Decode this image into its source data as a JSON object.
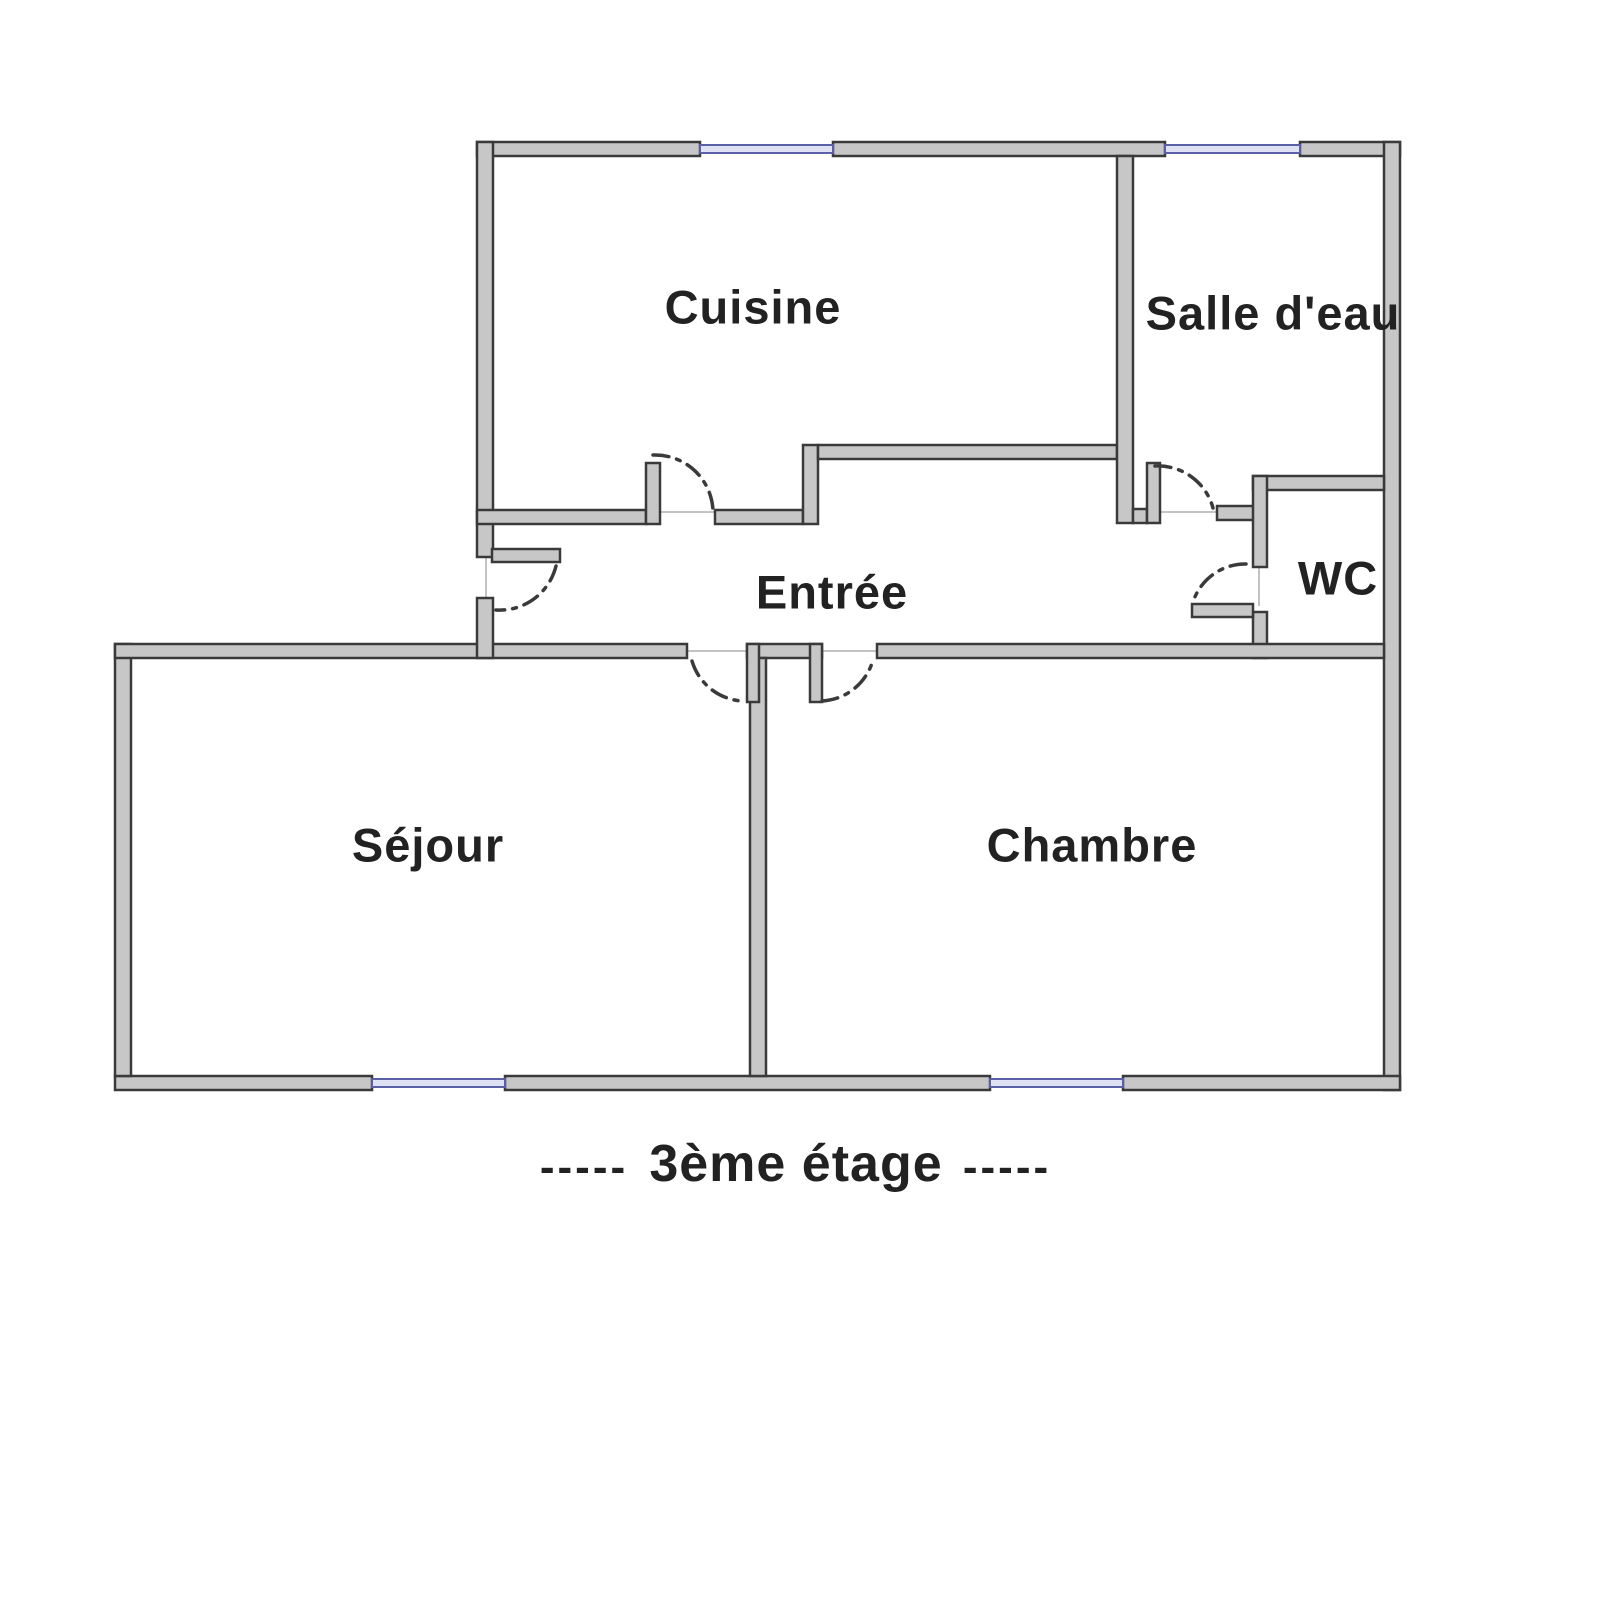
{
  "diagram": {
    "type": "floor-plan",
    "title": "3ème étage",
    "rooms": [
      {
        "id": "cuisine",
        "label": "Cuisine",
        "label_x": 753,
        "label_y": 307
      },
      {
        "id": "salle-deau",
        "label": "Salle d'eau",
        "label_x": 1273,
        "label_y": 313
      },
      {
        "id": "wc",
        "label": "WC",
        "label_x": 1338,
        "label_y": 578
      },
      {
        "id": "entree",
        "label": "Entrée",
        "label_x": 832,
        "label_y": 592
      },
      {
        "id": "sejour",
        "label": "Séjour",
        "label_x": 428,
        "label_y": 845
      },
      {
        "id": "chambre",
        "label": "Chambre",
        "label_x": 1092,
        "label_y": 845
      }
    ],
    "caption_items": [
      {
        "name": "caption-dashes-left",
        "text": "-----",
        "x": 584,
        "y": 1167,
        "size": 44
      },
      {
        "name": "caption-title",
        "text": "3ème étage",
        "x": 796,
        "y": 1164,
        "size": 52
      },
      {
        "name": "caption-dashes-right",
        "text": "-----",
        "x": 1007,
        "y": 1167,
        "size": 44
      }
    ],
    "colors": {
      "background": "#ffffff",
      "wall_fill": "#c7c7c7",
      "wall_stroke": "#3a3a3a",
      "window_fill": "#dde1f3",
      "window_stroke": "#5b5fa5",
      "door_arc": "#3a3a3a",
      "opening_line": "#c3c3c3",
      "label_color": "#222222"
    },
    "geometry": {
      "canvas": [
        1600,
        1600
      ],
      "label_font_size": 47,
      "walls": [
        [
          477,
          142,
          223,
          14
        ],
        [
          833,
          142,
          332,
          14
        ],
        [
          1300,
          142,
          100,
          14
        ],
        [
          1384,
          142,
          16,
          948
        ],
        [
          115,
          1076,
          257,
          14
        ],
        [
          505,
          1076,
          485,
          14
        ],
        [
          1123,
          1076,
          277,
          14
        ],
        [
          115,
          644,
          16,
          432
        ],
        [
          115,
          644,
          572,
          14
        ],
        [
          477,
          142,
          16,
          415
        ],
        [
          477,
          598,
          16,
          60
        ],
        [
          477,
          510,
          169,
          14
        ],
        [
          715,
          510,
          88,
          14
        ],
        [
          803,
          445,
          15,
          79
        ],
        [
          818,
          445,
          299,
          14
        ],
        [
          1117,
          156,
          16,
          367
        ],
        [
          1133,
          509,
          14,
          14
        ],
        [
          1217,
          506,
          43,
          14
        ],
        [
          1253,
          476,
          131,
          14
        ],
        [
          1253,
          476,
          14,
          91
        ],
        [
          1253,
          612,
          14,
          46
        ],
        [
          877,
          644,
          507,
          14
        ],
        [
          747,
          644,
          75,
          14
        ],
        [
          750,
          658,
          16,
          418
        ]
      ],
      "door_leaves": [
        [
          646,
          463,
          14,
          61
        ],
        [
          492,
          549,
          68,
          13
        ],
        [
          1147,
          463,
          13,
          60
        ],
        [
          1192,
          604,
          61,
          13
        ],
        [
          747,
          644,
          12,
          58
        ],
        [
          810,
          644,
          12,
          58
        ]
      ],
      "windows": [
        [
          700,
          145,
          133,
          8
        ],
        [
          1165,
          145,
          135,
          8
        ],
        [
          372,
          1079,
          133,
          8
        ],
        [
          990,
          1079,
          133,
          8
        ]
      ],
      "door_arcs": [
        "M 653 455 A 58 58 0 0 1 713 511",
        "M 556 566 A 58 58 0 0 1 496 610",
        "M 692 661 A 56 56 0 0 0 742 701",
        "M 822 701 A 56 56 0 0 0 873 660",
        "M 1155 466 A 57 57 0 0 1 1213 508",
        "M 1246 564 A 55 55 0 0 0 1193 602"
      ],
      "opening_lines": [
        [
          640,
          512,
          715,
          512
        ],
        [
          486,
          557,
          486,
          600
        ],
        [
          687,
          651,
          747,
          651
        ],
        [
          822,
          651,
          877,
          651
        ],
        [
          1160,
          512,
          1217,
          512
        ],
        [
          1259,
          567,
          1259,
          606
        ]
      ]
    }
  }
}
